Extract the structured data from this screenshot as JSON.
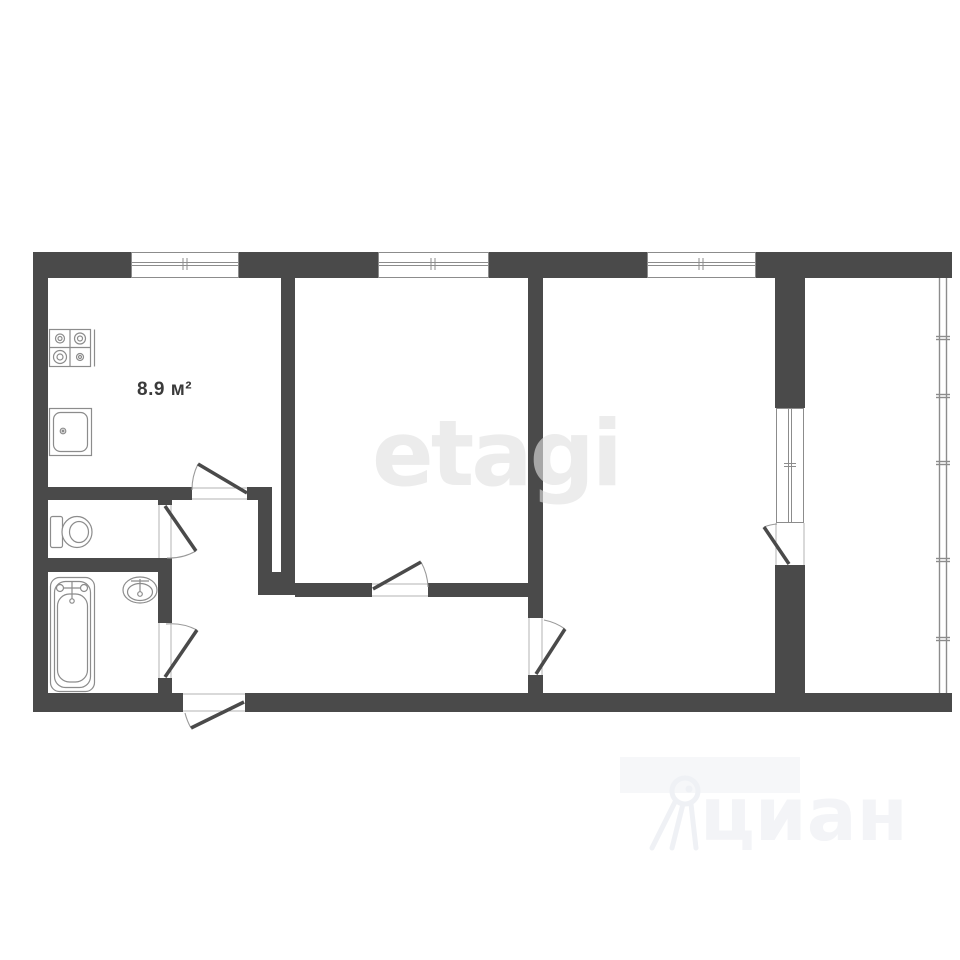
{
  "floorplan": {
    "rooms": {
      "kitchen_area_label": "8.9 м²"
    },
    "watermarks": {
      "etagi": "etagi",
      "cian": "циан"
    },
    "colors": {
      "wall": "#4a4a4a",
      "fixture_stroke": "#8c8c8c",
      "opening_stroke": "#b3b3b3",
      "arc_stroke": "#9a9a9a",
      "thin_wall_stroke": "#8c8c8c",
      "label_text": "#3a3a3a",
      "watermark_etagi": "#e4e4e4",
      "watermark_cian": "#f3f4f7",
      "background": "#ffffff"
    }
  }
}
